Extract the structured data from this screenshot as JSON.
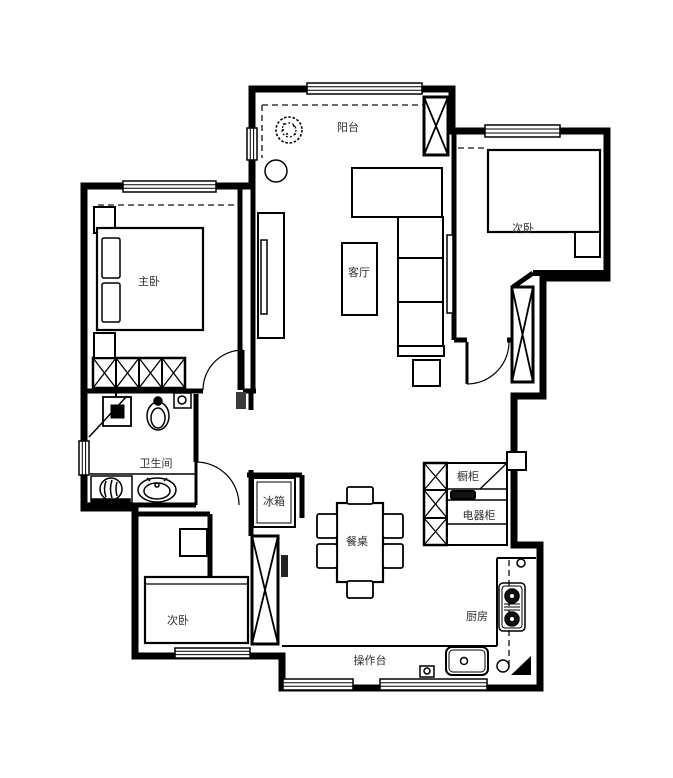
{
  "colors": {
    "wall": "#000000",
    "label": "#2f2f2f",
    "background": "#ffffff"
  },
  "rooms": {
    "balcony": {
      "label": "阳台"
    },
    "living_room": {
      "label": "客厅"
    },
    "master_bedroom": {
      "label": "主卧"
    },
    "bedroom_top_right": {
      "label": "次卧"
    },
    "bathroom": {
      "label": "卫生间"
    },
    "bedroom_bottom_left": {
      "label": "次卧"
    },
    "kitchen": {
      "label": "厨房"
    }
  },
  "fixtures": {
    "fridge": {
      "label": "冰箱"
    },
    "dining_table": {
      "label": "餐桌"
    },
    "cupboard": {
      "label": "橱柜"
    },
    "appliance_cabinet": {
      "label": "电器柜"
    },
    "countertop": {
      "label": "操作台"
    }
  }
}
